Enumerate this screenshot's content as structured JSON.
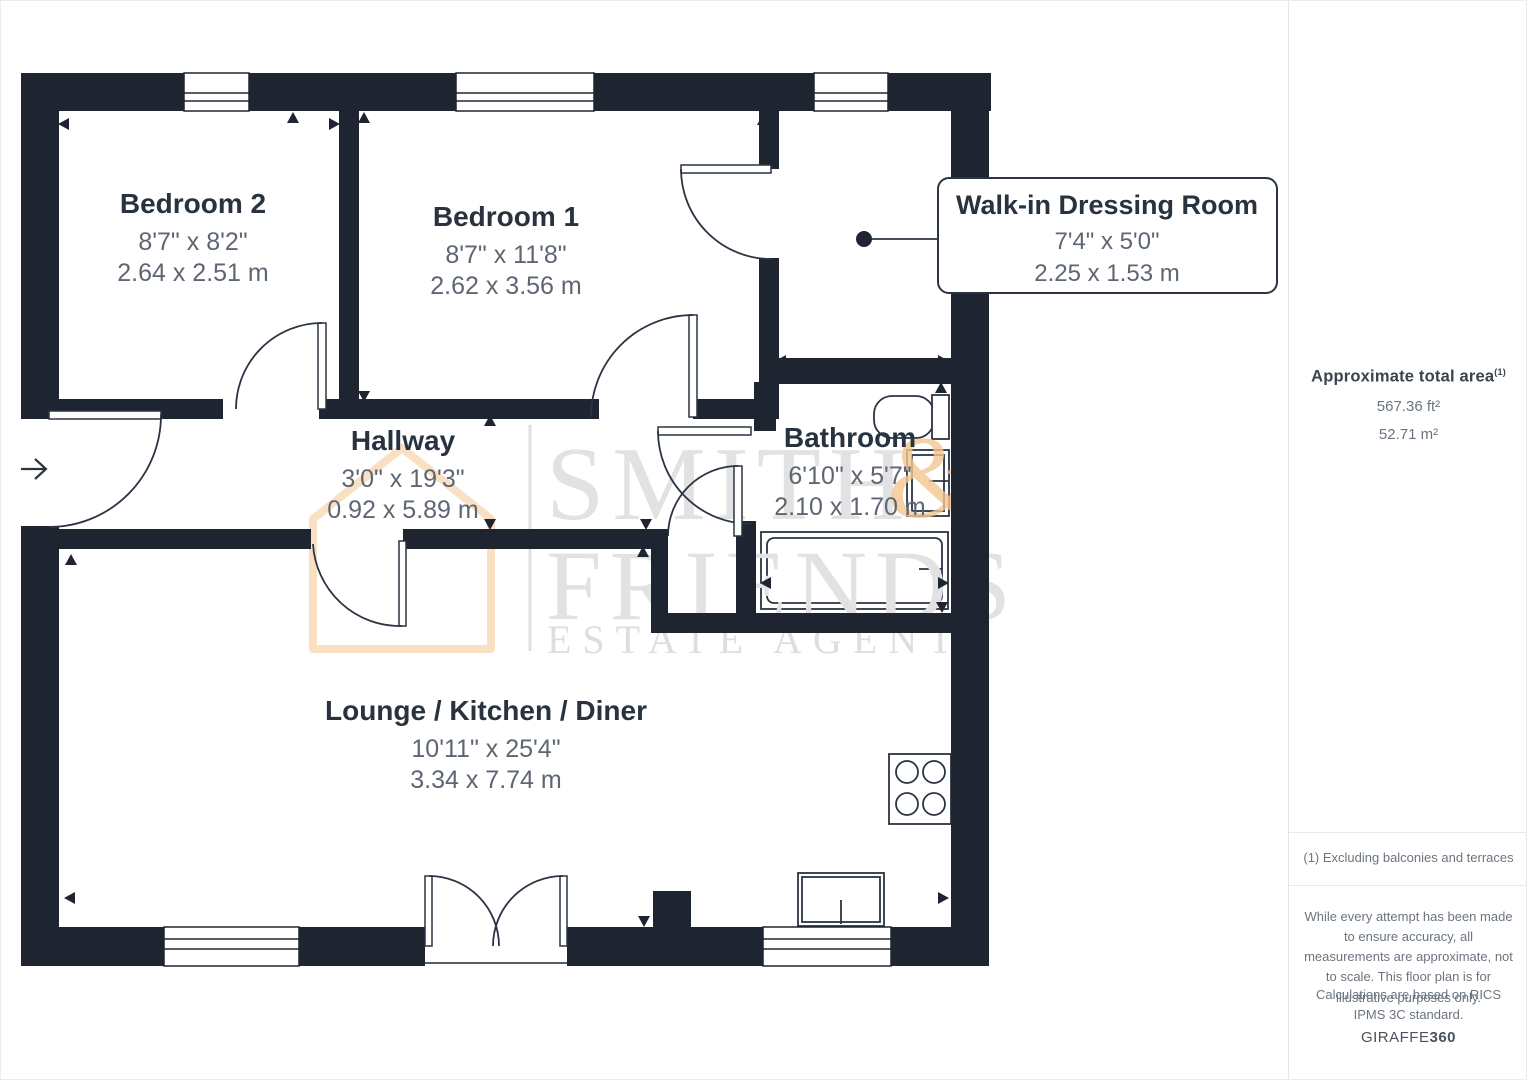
{
  "floor_plan": {
    "rooms": [
      {
        "name": "Bedroom 2",
        "imperial": "8'7\" x 8'2\"",
        "metric": "2.64 x 2.51 m"
      },
      {
        "name": "Bedroom 1",
        "imperial": "8'7\" x 11'8\"",
        "metric": "2.62 x 3.56 m"
      },
      {
        "name": "Walk-in Dressing Room",
        "imperial": "7'4\" x 5'0\"",
        "metric": "2.25 x 1.53 m"
      },
      {
        "name": "Hallway",
        "imperial": "3'0\" x 19'3\"",
        "metric": "0.92 x 5.89 m"
      },
      {
        "name": "Bathroom",
        "imperial": "6'10\" x 5'7\"",
        "metric": "2.10 x 1.70 m"
      },
      {
        "name": "Lounge / Kitchen / Diner",
        "imperial": "10'11\" x 25'4\"",
        "metric": "3.34 x 7.74 m"
      }
    ],
    "watermark": {
      "line1": "SMITH",
      "amp": "&",
      "line2": "FRIENDS",
      "line3": "ESTATE AGENTS"
    }
  },
  "sidebar": {
    "area_title": "Approximate total area",
    "area_superscript": "(1)",
    "area_ft": "567.36 ft²",
    "area_m": "52.71 m²",
    "footnote": "(1) Excluding balconies and terraces",
    "disclaimer": "While every attempt has been made to ensure accuracy, all measurements are approximate, not to scale. This floor plan is for illustrative purposes only.",
    "standard": "Calculations are based on RICS IPMS 3C standard.",
    "brand": "GIRAFFE",
    "brand_bold": "360"
  },
  "colors": {
    "wall": "#1e2531",
    "line": "#2a3442",
    "label": "#28333f",
    "dim": "#5d6673",
    "wm_gray": "#e2e2e2",
    "wm_orange": "#f6c690",
    "sidebar_border": "#e4e4e4",
    "sidebar_heading": "#3a424d",
    "sidebar_body": "#6b7480"
  }
}
